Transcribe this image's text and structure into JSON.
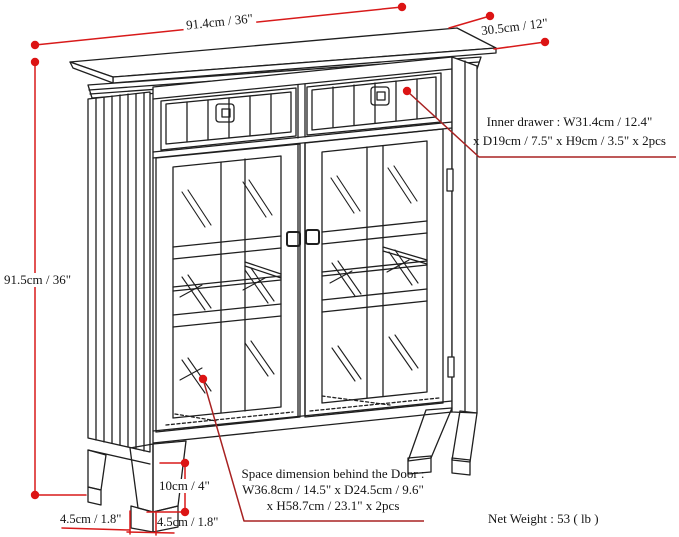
{
  "diagram": {
    "subject": "cabinet-dimension-diagram",
    "dimensions": {
      "width": "91.4cm / 36\"",
      "depth": "30.5cm / 12\"",
      "height": "91.5cm / 36\"",
      "leg_height": "10cm / 4\"",
      "foot_width_back": "4.5cm / 1.8\"",
      "foot_width_front": "4.5cm / 1.8\""
    },
    "annotations": {
      "inner_drawer_line1": "Inner drawer : W31.4cm / 12.4\"",
      "inner_drawer_line2": "x D19cm / 7.5\" x H9cm / 3.5\" x 2pcs",
      "space_line1": "Space dimension behind the Door :",
      "space_line2": "W36.8cm / 14.5\" x D24.5cm / 9.6\"",
      "space_line3": "x H58.7cm / 23.1\" x 2pcs",
      "net_weight": "Net Weight : 53 ( lb )"
    },
    "colors": {
      "dimension_red": "#d81a1a",
      "leader_red": "#a82222",
      "line_black": "#1f1f1f"
    }
  }
}
